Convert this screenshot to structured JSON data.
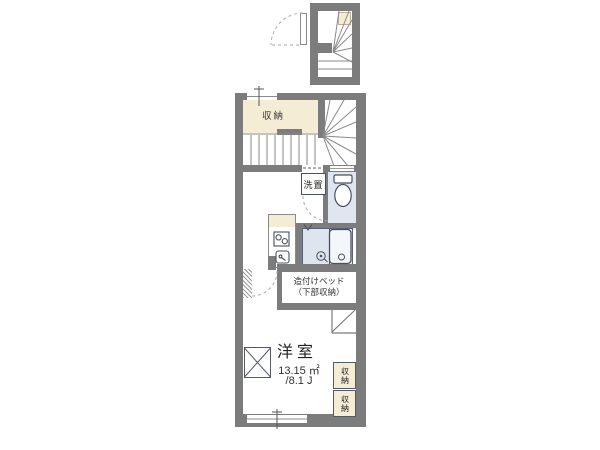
{
  "type": "apartment-floorplan",
  "rooms": {
    "upper_storage": {
      "label": "収納"
    },
    "washer": {
      "label": "洗置"
    },
    "bed": {
      "line1": "造付けベッド",
      "line2": "（下部収納）"
    },
    "main_room": {
      "name": "洋室",
      "area_sqm": "13.15 ㎡",
      "area_tatami": "/8.1 J"
    },
    "closet_top": {
      "label": "収納"
    },
    "closet_bottom": {
      "label": "収納"
    }
  },
  "icons": {
    "toilet": "toilet-icon",
    "bathtub": "bathtub-icon",
    "stove": "stove-icon",
    "sink": "sink-icon",
    "window": "window-x-icon",
    "door": "door-swing-arc",
    "stairs": "staircase-lines"
  },
  "colors": {
    "wall": "#7c7c7c",
    "storage_fill": "#f5ecd5",
    "wet_area_fill": "#e0e6ef",
    "background": "#ffffff",
    "linework": "#8a8a8a"
  }
}
